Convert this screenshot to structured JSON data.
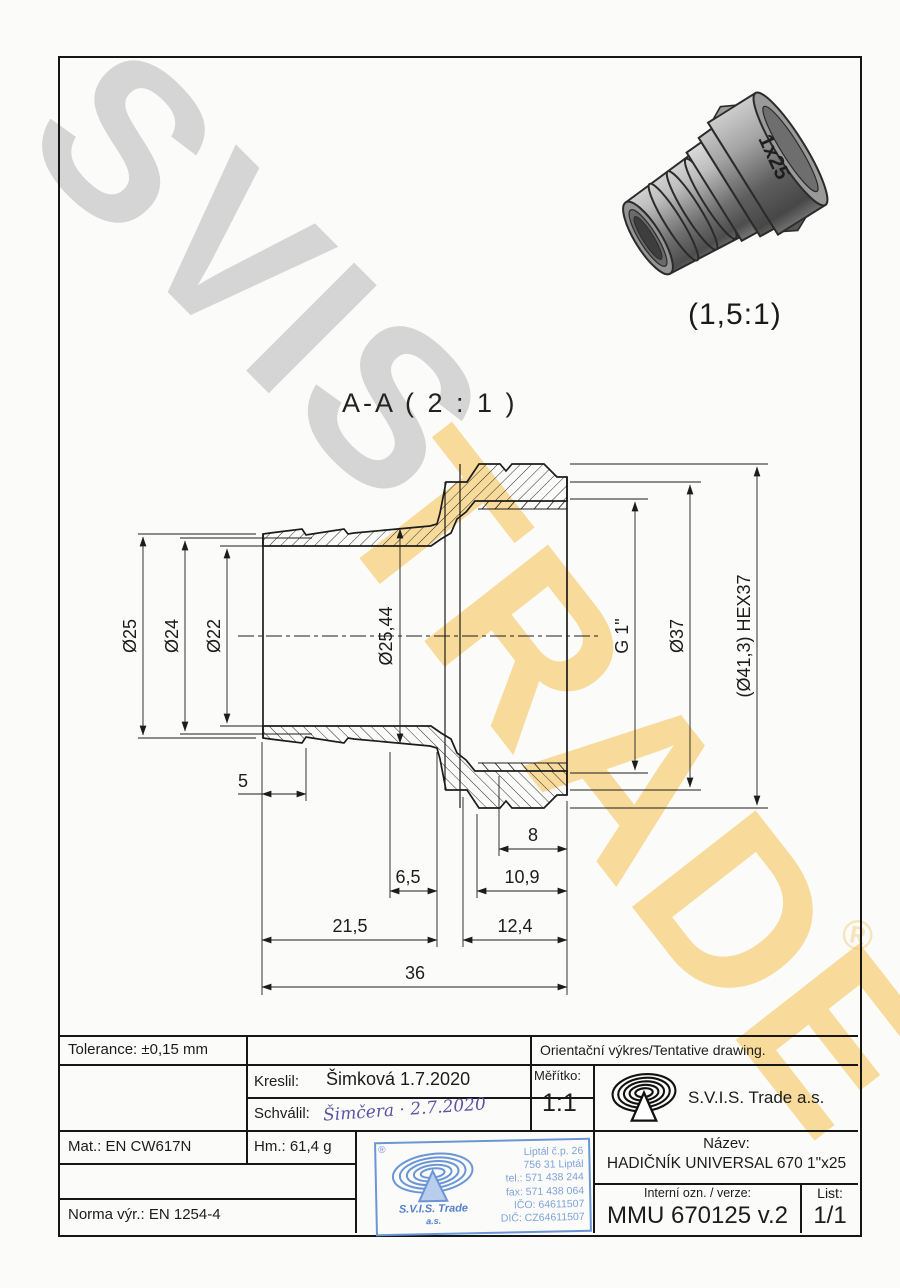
{
  "watermark": {
    "word1": "SVIS",
    "word2": "TRADE",
    "registered": "®",
    "gray": "#d5d5d5",
    "yellow": "#f6c75f"
  },
  "iso_view": {
    "scale_label": "(1,5:1)",
    "engraving": "1x25"
  },
  "section_view": {
    "label": "A-A ( 2 : 1 )"
  },
  "dims": {
    "d25": "Ø25",
    "d24": "Ø24",
    "d22": "Ø22",
    "d2544": "Ø25,44",
    "g1": "G 1\"",
    "d37": "Ø37",
    "hex37": "(Ø41,3) HEX37",
    "l5": "5",
    "l8": "8",
    "l65": "6,5",
    "l109": "10,9",
    "l215": "21,5",
    "l124": "12,4",
    "l36": "36"
  },
  "title_block": {
    "tolerance": "Tolerance: ±0,15 mm",
    "orientacni": "Orientační výkres/Tentative drawing.",
    "kreslil_label": "Kreslil:",
    "kreslil_value": "Šimková 1.7.2020",
    "schvalil_label": "Schválil:",
    "schvalil_signature": "Šimčera · 2.7.2020",
    "meritko_label": "Měřítko:",
    "meritko_value": "1:1",
    "company": "S.V.I.S. Trade a.s.",
    "mat": "Mat.: EN CW617N",
    "hm": "Hm.: 61,4 g",
    "norma": "Norma výr.: EN 1254-4",
    "nazev_label": "Název:",
    "nazev_value": "HADIČNÍK UNIVERSAL 670 1\"x25",
    "interni_label": "Interní ozn. / verze:",
    "interni_value": "MMU 670125 v.2",
    "list_label": "List:",
    "list_value": "1/1"
  },
  "stamp": {
    "registered": "®",
    "company_line1": "S.V.I.S. Trade",
    "company_line2": "a.s.",
    "address1": "Liptál č.p. 26",
    "address2": "756 31 Liptál",
    "tel": "tel.: 571 438 244",
    "fax": "fax: 571 438 064",
    "ico": "IČO: 64611507",
    "dic": "DIČ: CZ64611507",
    "blue": "#5b87cf"
  },
  "colors": {
    "line": "#1c1c1c",
    "signature_ink": "#5a54a6"
  }
}
